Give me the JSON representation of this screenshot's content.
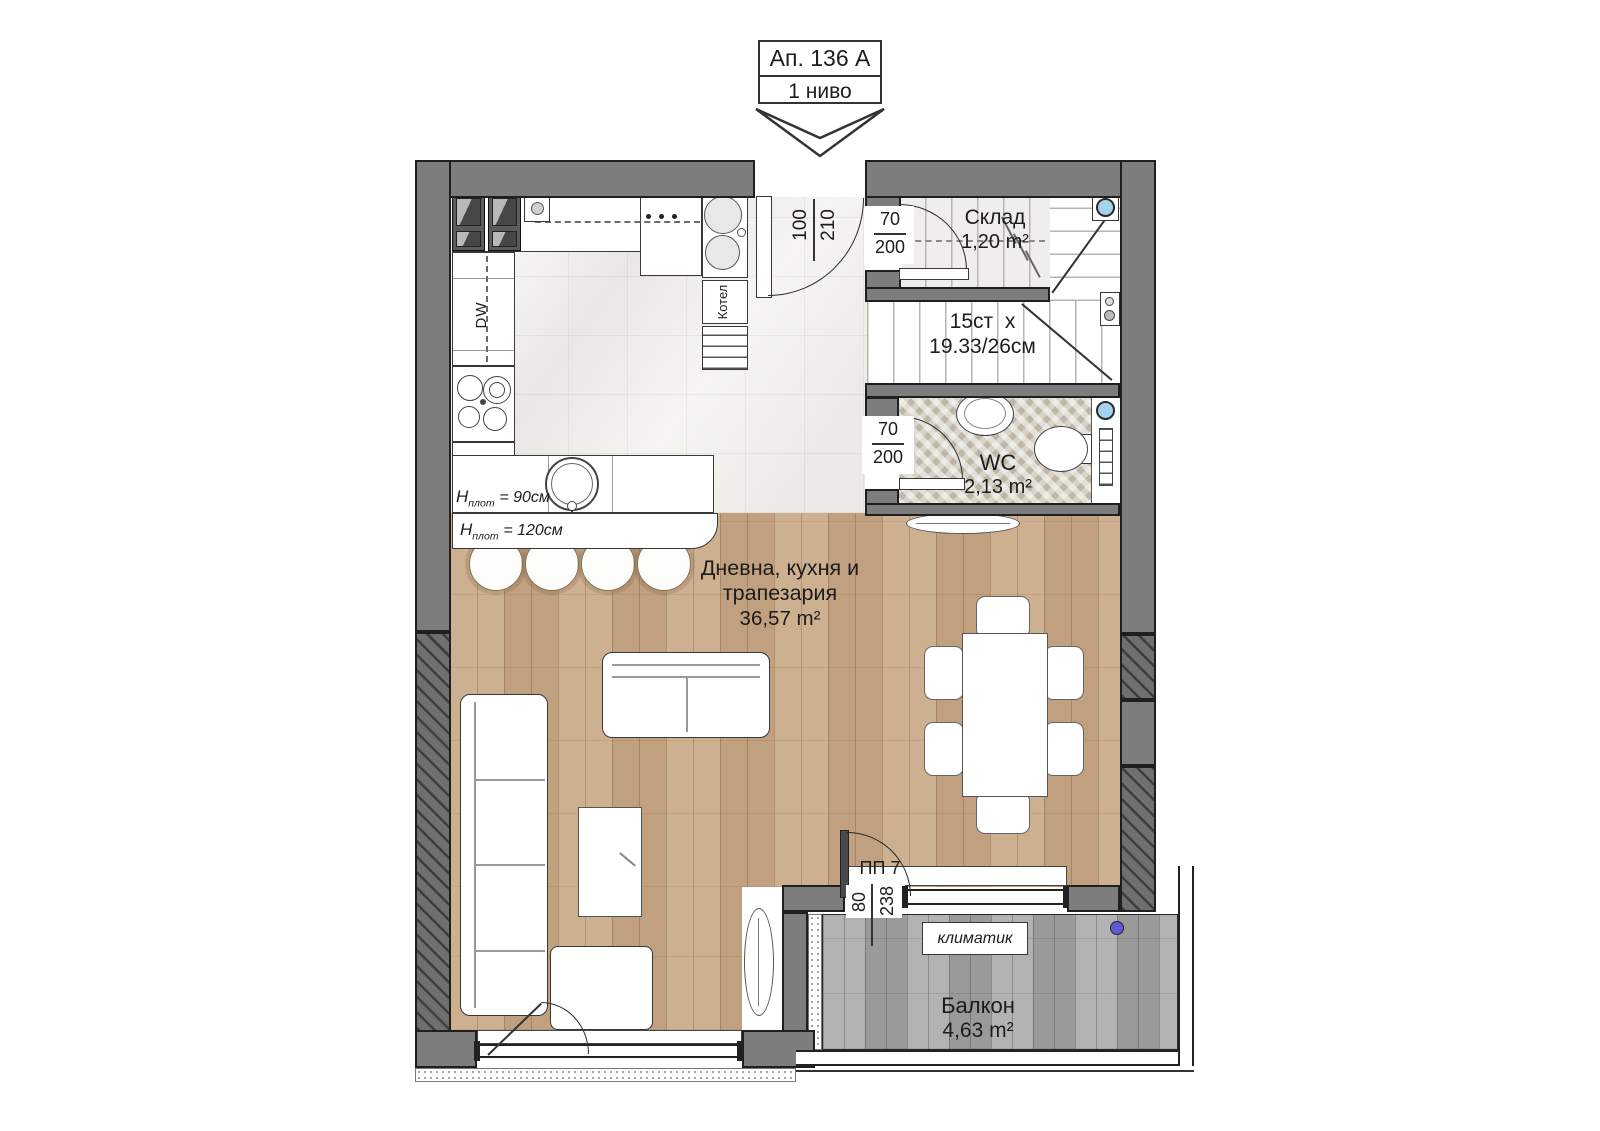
{
  "title": {
    "apartment": "Ап. 136 А",
    "level": "1 ниво"
  },
  "rooms": {
    "living": {
      "line1": "Дневна, кухня и",
      "line2": "трапезария",
      "area": "36,57 m²"
    },
    "storage": {
      "name": "Склад",
      "area": "1,20 m²"
    },
    "wc": {
      "name": "WC",
      "area": "2,13 m²"
    },
    "balcony": {
      "name": "Балкон",
      "area": "4,63 m²"
    },
    "stairs": {
      "line1": "15ст  х",
      "line2": "19.33/26см"
    }
  },
  "dimensions": {
    "entrance": {
      "width": "100",
      "height": "210"
    },
    "storage_door": {
      "width": "70",
      "height": "200"
    },
    "wc_door": {
      "width": "70",
      "height": "200"
    },
    "balcony_door": {
      "label": "ПП 7",
      "width": "80",
      "height": "238"
    }
  },
  "kitchen": {
    "dishwasher": "DW",
    "boiler": "Котел",
    "counter_90": {
      "symbol": "H",
      "sub": "плот",
      "value": "= 90см"
    },
    "counter_120": {
      "symbol": "H",
      "sub": "плот",
      "value": "= 120см"
    }
  },
  "balcony_items": {
    "ac": "климатик"
  },
  "colors": {
    "wall": "#7d7d7d",
    "wood": "#c9a987",
    "deck": "#a8a8a8",
    "marble": "#f4f3f0",
    "blue_fixture": "#a5d2ef",
    "purple_dot": "#5b5bd6"
  }
}
